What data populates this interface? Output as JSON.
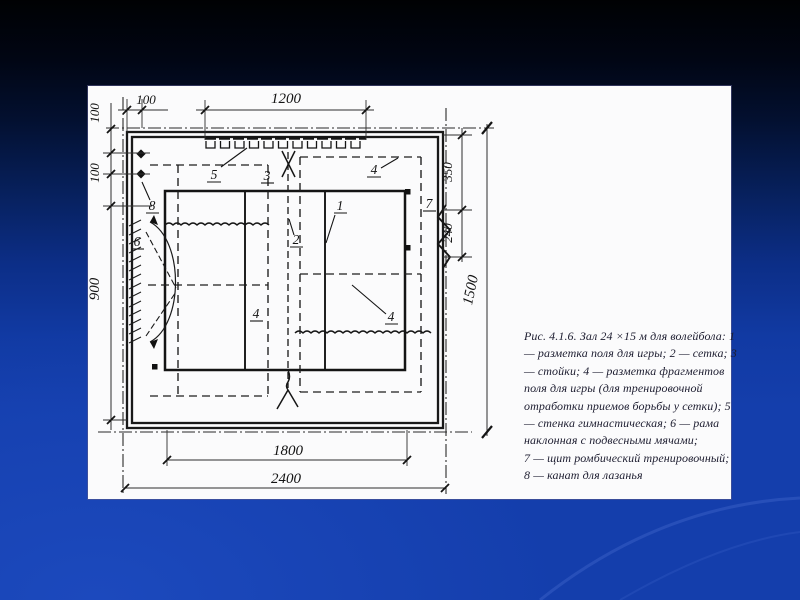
{
  "slide": {
    "colors": {
      "background_top": "#000103",
      "background_bottom": "#143eac",
      "panel": "#fbfbfc",
      "ink": "#1f1f1f"
    }
  },
  "figure": {
    "dimensions": {
      "top_offset": "100",
      "gym_wall_width": "1200",
      "left_offset_a": "100",
      "left_offset_b": "100",
      "left_height": "900",
      "right_top": "350",
      "right_mid": "240",
      "hall_width": "1500",
      "bottom_inner": "1800",
      "hall_length": "2400"
    },
    "callouts": {
      "court_marking": "1",
      "net": "2",
      "posts": "3",
      "fragment_marking": "4",
      "gym_wall": "5",
      "inclined_frame": "6",
      "rhombic_shield": "7",
      "climbing_rope": "8"
    },
    "caption": {
      "lines": [
        "Рис. 4.1.6. Зал 24 ×15 м для волейбола: 1",
        "— разметка поля для игры; 2 — сетка; 3",
        "— стойки; 4 — разметка фрагментов",
        "поля для игры (для тренировочной",
        "отработки приемов борьбы у сетки); 5",
        "— стенка гимнастическая; 6 — рама",
        "наклонная с подвесными мячами;",
        "7 — щит ромбический тренировочный;",
        "8 — канат для лазанья"
      ]
    }
  }
}
